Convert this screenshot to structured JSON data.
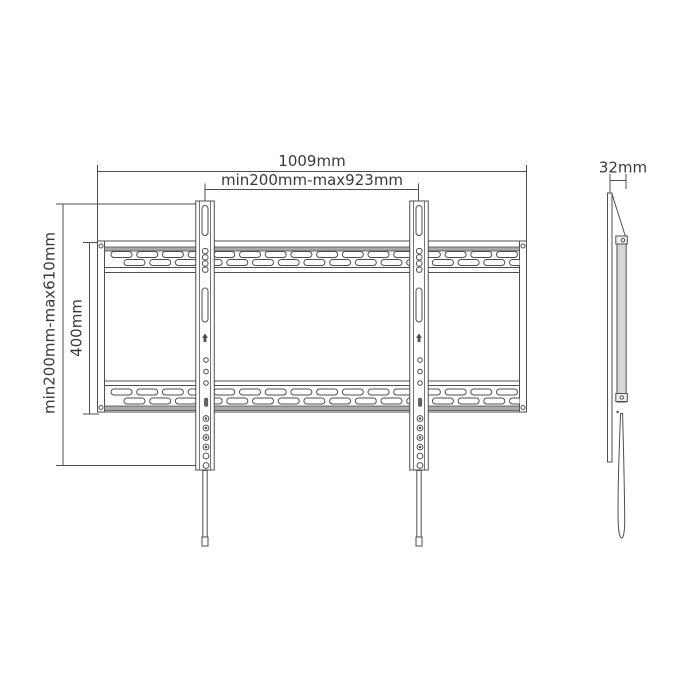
{
  "dimensions": {
    "overall_width": "1009mm",
    "mount_width_range": "min200mm-max923mm",
    "mount_height_range": "min200mm-max610mm",
    "plate_height": "400mm",
    "depth": "32mm"
  },
  "colors": {
    "line": "#4f4f4f",
    "text": "#3a3a3a",
    "rail_band": "#a9a9a9",
    "side_bracket_fill": "#d7d7d7",
    "background": "#ffffff"
  }
}
